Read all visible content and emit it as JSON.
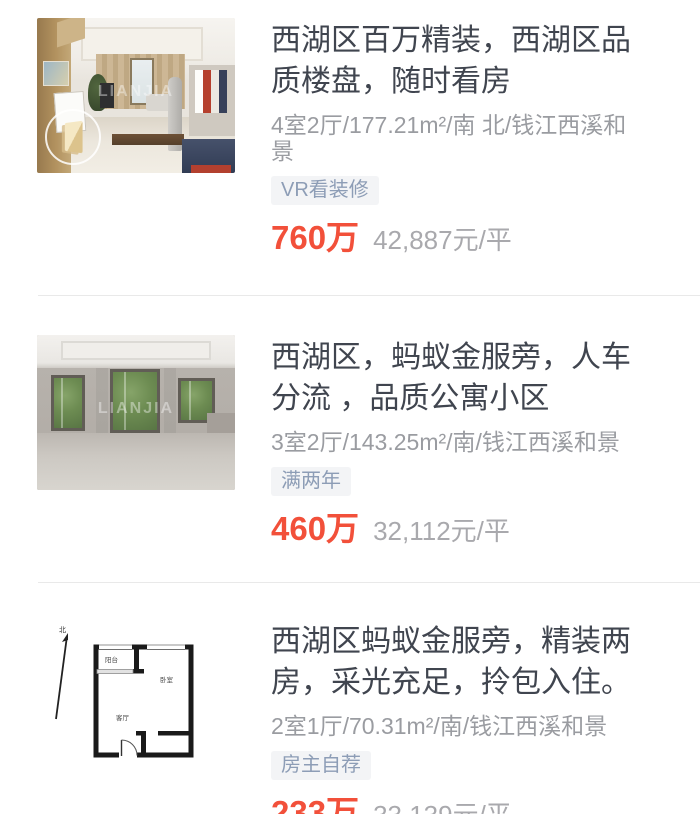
{
  "page": {
    "width": 700,
    "height": 814,
    "background": "#ffffff",
    "divider_color": "#e9e9e9"
  },
  "colors": {
    "title_text": "#40454f",
    "detail_text": "#9a9ca1",
    "tag_text": "#8d9db6",
    "tag_background": "#f3f4f6",
    "price_red": "#f2503a",
    "unit_price_text": "#a9a9ad"
  },
  "watermark": "LIANJIA",
  "listings": [
    {
      "title": "西湖区百万精装，西湖区品质楼盘，随时看房",
      "details": "4室2厅/177.21m²/南 北/钱江西溪和景",
      "tag": "VR看装修",
      "price": "760万",
      "unit_price": "42,887元/平",
      "image": "living-room-photo",
      "has_vr_badge": true
    },
    {
      "title": "西湖区，蚂蚁金服旁，人车分流 ，品质公寓小区",
      "details": "3室2厅/143.25m²/南/钱江西溪和景",
      "tag": "满两年",
      "price": "460万",
      "unit_price": "32,112元/平",
      "image": "empty-room-photo",
      "has_vr_badge": false
    },
    {
      "title": "西湖区蚂蚁金服旁，精装两房，采光充足，拎包入住。",
      "details": "2室1厅/70.31m²/南/钱江西溪和景",
      "tag": "房主自荐",
      "price": "233万",
      "unit_price": "33,139元/平",
      "image": "floorplan-drawing",
      "has_vr_badge": false,
      "floorplan": {
        "north_label": "北",
        "rooms": [
          "阳台",
          "卧室",
          "客厅"
        ]
      }
    }
  ]
}
